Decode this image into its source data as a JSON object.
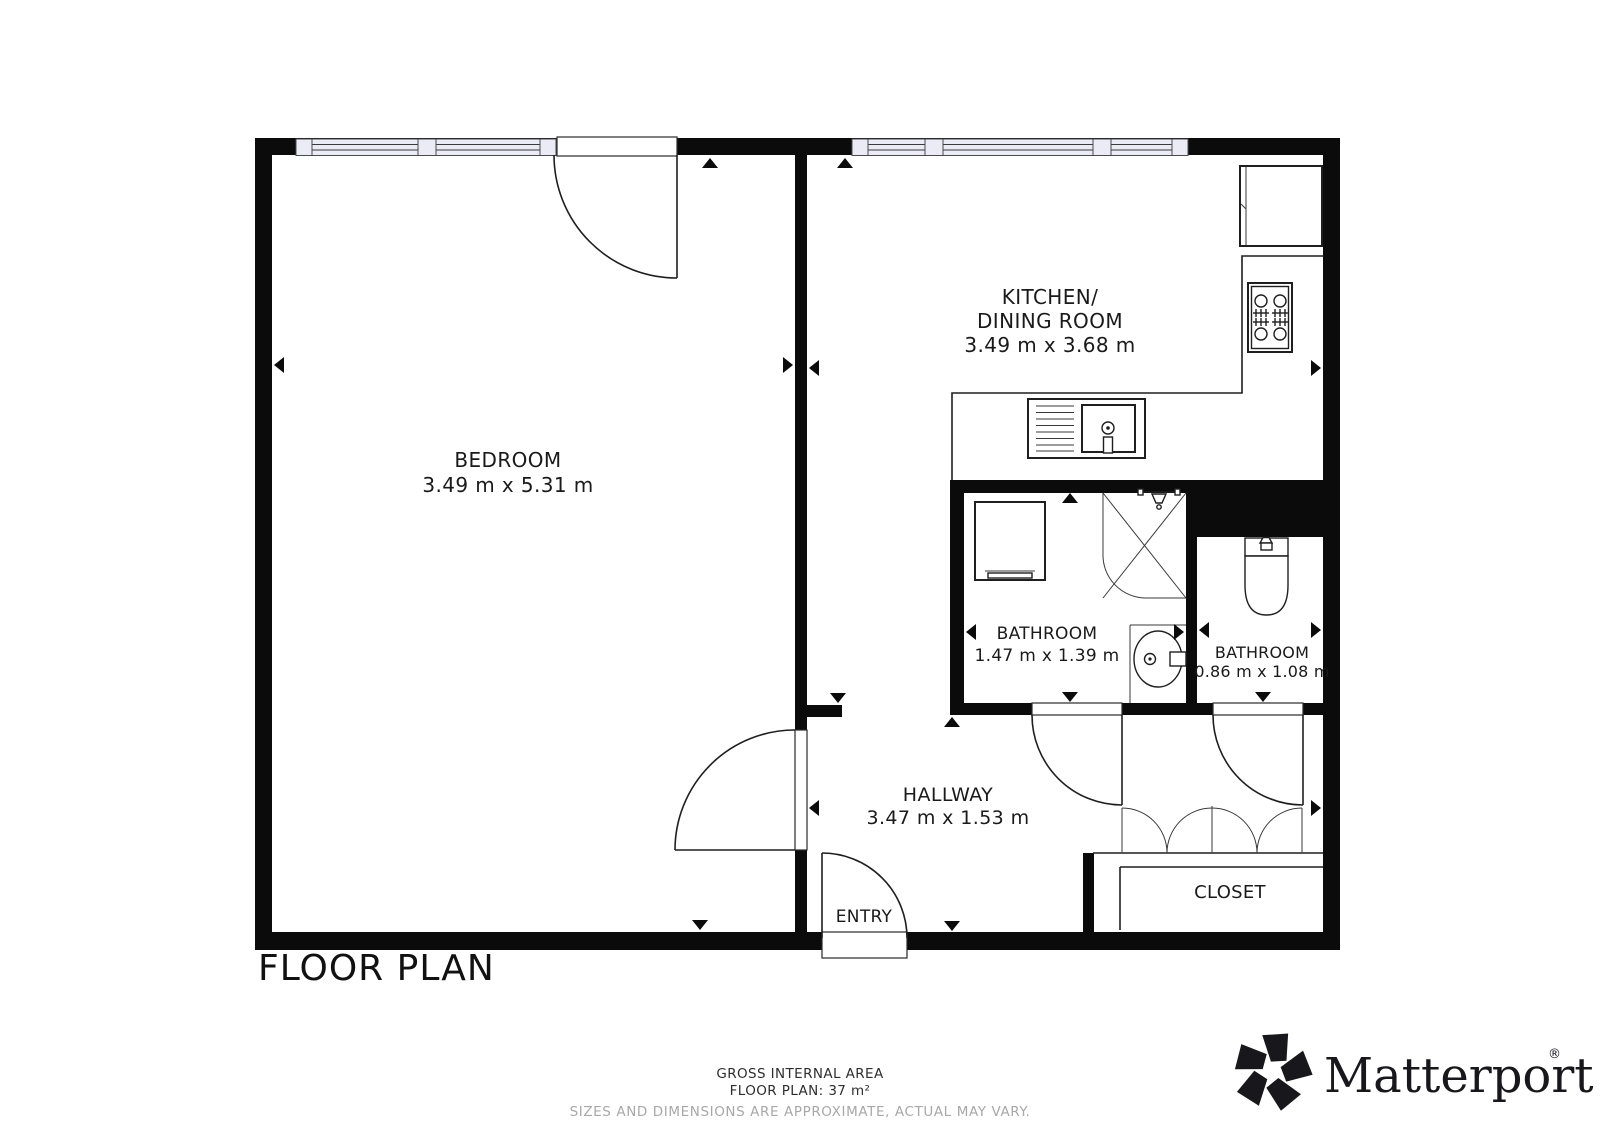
{
  "page": {
    "title": "FLOOR PLAN"
  },
  "rooms": {
    "bedroom": {
      "name": "BEDROOM",
      "dims": "3.49 m x 5.31 m"
    },
    "kitchen": {
      "name_line1": "KITCHEN/",
      "name_line2": "DINING ROOM",
      "dims": "3.49 m x 3.68 m"
    },
    "bathroom_main": {
      "name": "BATHROOM",
      "dims": "1.47 m x 1.39 m"
    },
    "bathroom_small": {
      "name": "BATHROOM",
      "dims": "0.86 m x 1.08 m"
    },
    "hallway": {
      "name": "HALLWAY",
      "dims": "3.47 m x 1.53 m"
    },
    "closet": {
      "name": "CLOSET"
    },
    "entry": {
      "name": "ENTRY"
    }
  },
  "footer": {
    "area_label": "GROSS INTERNAL AREA",
    "area_value": "FLOOR PLAN: 37 m²",
    "disclaimer": "SIZES AND DIMENSIONS ARE APPROXIMATE, ACTUAL MAY VARY."
  },
  "brand": {
    "wordmark": "Matterport",
    "registered_mark": "®"
  },
  "colors": {
    "wall": "#0b0b0b",
    "line": "#1f1f1f",
    "window_fill": "#eaebf5",
    "text": "#1a1a1a",
    "muted_text": "#a8a8a8",
    "background": "#ffffff"
  }
}
